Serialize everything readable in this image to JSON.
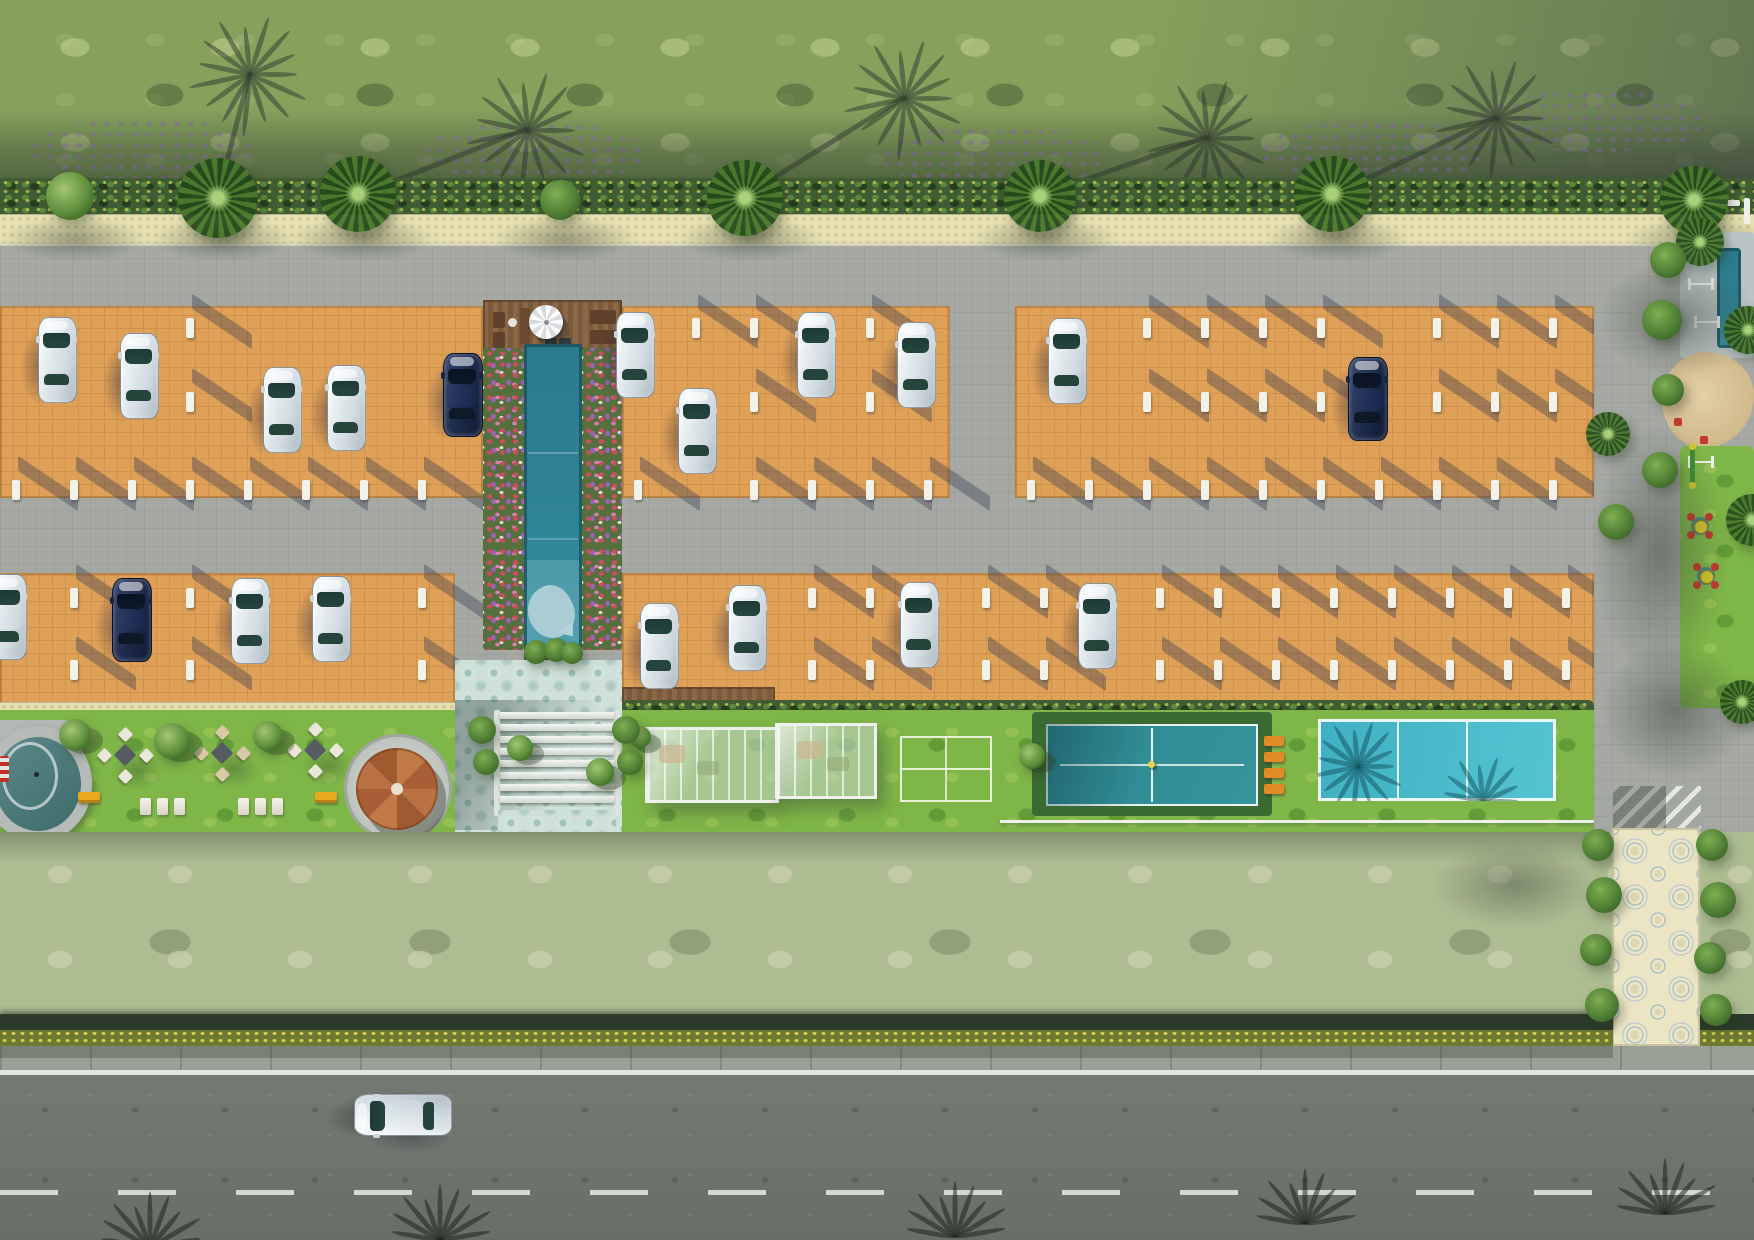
{
  "scene": {
    "type": "aerial-residential-site-plan-render",
    "canvas": {
      "w": 1754,
      "h": 1240
    },
    "palette": {
      "grass_top": "#85a15c",
      "grass_south": "#aebc92",
      "hedge_dark": "#3f5c33",
      "cream_strip": "#e7e1b1",
      "pavement": "#a6a9a3",
      "parking_orange": "#dfa057",
      "asphalt": "#6f746d",
      "sidewalk": "#9aa095",
      "pool_water": "#2e8194",
      "flower_bed": "#55703c",
      "amenity_lawn": "#7fb648",
      "court_teal": "#2f8d95",
      "court_cyan": "#48bac9",
      "deck_wood": "#82613f",
      "gazebo_roof": "#b06a3c",
      "walkway_tile": "#ebe5c4",
      "road_marking": "#e3e6e0",
      "car_white": "#dfe7ec",
      "car_navy": "#1a2746",
      "bench_yellow": "#e8aa1e",
      "bench_orange": "#e08a28",
      "play_red": "#c23a30",
      "play_yellow": "#d8c82e",
      "sand": "#d9c49a"
    },
    "bands": {
      "grass_top": [
        0,
        0,
        1754,
        180
      ],
      "hedge_top": [
        0,
        178,
        1754,
        38
      ],
      "walk_strip": [
        0,
        214,
        1754,
        32
      ],
      "boundary_line": [
        0,
        243,
        1754,
        4
      ],
      "paved_core": [
        0,
        246,
        1754,
        589
      ],
      "lawn_south": [
        0,
        832,
        1754,
        184
      ],
      "hedge_south": [
        0,
        1014,
        1613,
        18
      ],
      "hedge_south_right": [
        1700,
        1014,
        54,
        18
      ],
      "flower_row": [
        0,
        1030,
        1613,
        16
      ],
      "flower_row_right": [
        1700,
        1030,
        54,
        16
      ],
      "sidewalk": [
        0,
        1046,
        1754,
        26
      ],
      "stop_line": [
        0,
        1070,
        1754,
        5
      ],
      "road": [
        0,
        1075,
        1754,
        165
      ],
      "dash_line_y": 1190
    },
    "parking": {
      "blocks_upper": [
        [
          0,
          306,
          483,
          192
        ],
        [
          622,
          306,
          328,
          192
        ],
        [
          1015,
          306,
          579,
          192
        ]
      ],
      "blocks_lower": [
        [
          0,
          573,
          455,
          133
        ],
        [
          622,
          573,
          972,
          133
        ]
      ],
      "stop_rows_upper": [
        318,
        392,
        480
      ],
      "stop_rows_lower": [
        588,
        660
      ],
      "stop_gap": 58,
      "deck_strip": [
        622,
        687,
        153,
        19
      ]
    },
    "cars": {
      "size": {
        "len": 84,
        "wid": 37
      },
      "parked": [
        [
          38,
          317,
          "white"
        ],
        [
          120,
          333,
          "white"
        ],
        [
          263,
          367,
          "white"
        ],
        [
          327,
          365,
          "white"
        ],
        [
          443,
          353,
          "navy"
        ],
        [
          616,
          312,
          "white"
        ],
        [
          678,
          388,
          "white"
        ],
        [
          797,
          312,
          "white"
        ],
        [
          897,
          322,
          "white"
        ],
        [
          1048,
          318,
          "white"
        ],
        [
          1348,
          357,
          "navy"
        ],
        [
          -12,
          574,
          "white"
        ],
        [
          112,
          578,
          "navy"
        ],
        [
          231,
          578,
          "white"
        ],
        [
          312,
          576,
          "white"
        ],
        [
          640,
          603,
          "white"
        ],
        [
          728,
          585,
          "white"
        ],
        [
          900,
          582,
          "white"
        ],
        [
          1078,
          583,
          "white"
        ]
      ],
      "road_car": {
        "x": 382,
        "y": 1068,
        "color": "white",
        "len": 96,
        "wid": 40,
        "rot": -90
      }
    },
    "pool": {
      "deck": [
        483,
        300,
        139,
        50
      ],
      "umbrella": [
        529,
        305,
        34
      ],
      "water": [
        524,
        344,
        58,
        304
      ],
      "flowers_left": [
        483,
        348,
        41,
        302
      ],
      "flowers_right": [
        582,
        348,
        40,
        302
      ],
      "planter": [
        524,
        644,
        58,
        18
      ],
      "whale": [
        528,
        586,
        46,
        52
      ],
      "plaza": [
        455,
        660,
        167,
        175
      ],
      "steps": [
        500,
        712,
        114,
        100
      ]
    },
    "amenity": {
      "lawn_left": [
        0,
        710,
        455,
        125
      ],
      "lawn_right": [
        622,
        710,
        972,
        125
      ],
      "hedge_strip_cream": [
        0,
        702,
        455,
        24
      ],
      "hedge_strip_bush": [
        622,
        700,
        972,
        28
      ],
      "oval_structure": [
        -16,
        726,
        86,
        94
      ],
      "picnic_clusters": [
        [
          125,
          755
        ],
        [
          222,
          753
        ],
        [
          315,
          750
        ]
      ],
      "benches_yellow": [
        [
          78,
          792
        ],
        [
          315,
          792
        ]
      ],
      "lounger_rows": [
        [
          140,
          798
        ],
        [
          238,
          798
        ]
      ],
      "gazebo": {
        "pad": [
          344,
          734,
          108
        ],
        "roof": [
          356,
          748,
          82
        ]
      },
      "pavilion": [
        [
          645,
          727,
          128,
          70
        ],
        [
          775,
          723,
          96,
          70
        ]
      ],
      "badminton": [
        900,
        736,
        92,
        66
      ],
      "court_teal": {
        "frame": [
          1032,
          712,
          240,
          104
        ],
        "court": [
          1046,
          724,
          212,
          82
        ]
      },
      "benches_orange": [
        [
          1264,
          736
        ],
        [
          1264,
          752
        ],
        [
          1264,
          768
        ],
        [
          1264,
          784
        ]
      ],
      "court_cyan": [
        1318,
        719,
        238,
        82
      ],
      "rail": [
        1000,
        820,
        610,
        3
      ]
    },
    "right_side": {
      "pavement": [
        1594,
        246,
        160,
        589
      ],
      "pad_top": [
        1680,
        232,
        74,
        126
      ],
      "teal_pool": [
        1717,
        248,
        24,
        100
      ],
      "sand": [
        1662,
        352,
        92,
        96
      ],
      "green_strip": [
        1680,
        446,
        74,
        262
      ],
      "gym_glyphs": [
        [
          1688,
          248
        ],
        [
          1688,
          278
        ],
        [
          1694,
          316
        ],
        [
          1688,
          456
        ]
      ],
      "seesaw": [
        1690,
        448
      ],
      "spinners": [
        [
          1700,
          526
        ],
        [
          1706,
          576
        ]
      ],
      "red_items": [
        [
          1674,
          418
        ],
        [
          1700,
          436
        ]
      ],
      "fence": [
        [
          1706,
          200,
          34,
          6
        ],
        [
          1744,
          198,
          6,
          26
        ]
      ],
      "crosswalk": [
        1613,
        786,
        88,
        42
      ],
      "walkway": [
        1612,
        828,
        88,
        218
      ]
    },
    "vegetation": {
      "hedge_palms": [
        [
          70,
          196,
          24,
          "tree"
        ],
        [
          218,
          198,
          40,
          "palm"
        ],
        [
          358,
          194,
          38,
          "palm"
        ],
        [
          560,
          200,
          20,
          "bush"
        ],
        [
          745,
          198,
          38,
          "palm"
        ],
        [
          1040,
          196,
          36,
          "palm"
        ],
        [
          1332,
          194,
          38,
          "palm"
        ],
        [
          1694,
          200,
          34,
          "palm"
        ]
      ],
      "right_palms": [
        [
          1608,
          434,
          22,
          "palm"
        ],
        [
          1616,
          522,
          18,
          "bush"
        ],
        [
          1700,
          242,
          24,
          "palm"
        ],
        [
          1748,
          330,
          24,
          "palm"
        ],
        [
          1752,
          520,
          26,
          "palm"
        ],
        [
          1742,
          702,
          22,
          "palm"
        ],
        [
          1668,
          260,
          18,
          "bush"
        ],
        [
          1662,
          320,
          20,
          "bush"
        ],
        [
          1668,
          390,
          16,
          "bush"
        ],
        [
          1660,
          470,
          18,
          "bush"
        ]
      ],
      "amenity_trees": [
        [
          75,
          735,
          16
        ],
        [
          172,
          741,
          18
        ],
        [
          268,
          736,
          15
        ],
        [
          520,
          748,
          13
        ],
        [
          600,
          772,
          14
        ],
        [
          640,
          737,
          11
        ],
        [
          1032,
          756,
          13
        ]
      ],
      "walkway_bushes": [
        [
          1598,
          845,
          16
        ],
        [
          1604,
          895,
          18
        ],
        [
          1596,
          950,
          16
        ],
        [
          1602,
          1005,
          17
        ],
        [
          1712,
          845,
          16
        ],
        [
          1718,
          900,
          18
        ],
        [
          1710,
          958,
          16
        ],
        [
          1716,
          1010,
          16
        ]
      ],
      "pool_planter_bushes": [
        [
          536,
          652,
          12
        ],
        [
          556,
          650,
          12
        ],
        [
          572,
          653,
          11
        ]
      ],
      "step_planters": [
        [
          482,
          730,
          14
        ],
        [
          486,
          762,
          13
        ],
        [
          626,
          730,
          14
        ],
        [
          630,
          762,
          13
        ]
      ],
      "purple_patches": [
        [
          30,
          118
        ],
        [
          420,
          122
        ],
        [
          880,
          126
        ],
        [
          1260,
          120
        ],
        [
          1480,
          90
        ]
      ]
    },
    "shadows": {
      "top_fans": [
        [
          250,
          72,
          218
        ],
        [
          528,
          128,
          358
        ],
        [
          905,
          96,
          745
        ],
        [
          1208,
          136,
          1040
        ],
        [
          1497,
          116,
          1332
        ]
      ],
      "road_fans": [
        [
          150,
          1245
        ],
        [
          440,
          1238
        ],
        [
          955,
          1235
        ],
        [
          1305,
          1222
        ],
        [
          1665,
          1212
        ]
      ],
      "court_fans": [
        [
          40,
          45
        ],
        [
          165,
          80
        ]
      ],
      "pavement_blobs": [
        [
          1598,
          258,
          160,
          120
        ],
        [
          1590,
          420,
          140,
          260
        ],
        [
          1600,
          640,
          150,
          140
        ],
        [
          1604,
          1080,
          180,
          90
        ]
      ]
    }
  }
}
